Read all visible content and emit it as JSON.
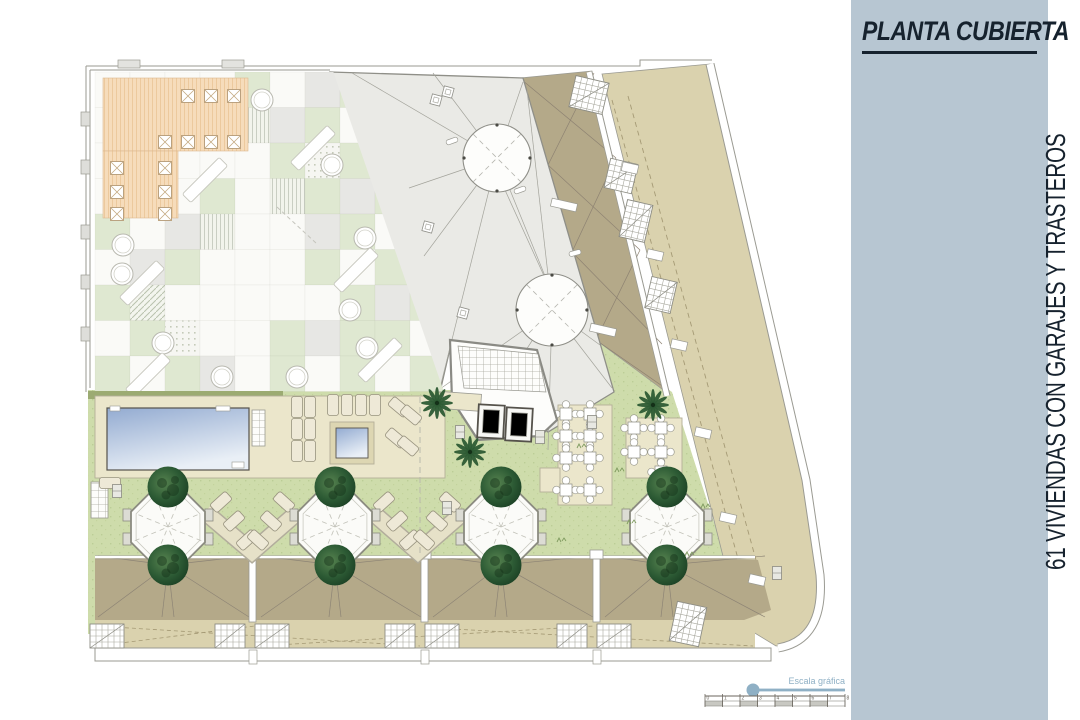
{
  "sidebar": {
    "title": "PLANTA CUBIERTA",
    "subtitle_vertical": "61 VIVIENDAS CON GARAJES Y TRASTEROS",
    "bg": "#b7c6d2",
    "text_color": "#16222e"
  },
  "scalebar": {
    "label": "Escala gráfica",
    "numbers": [
      "0",
      "1",
      "2",
      "3",
      "4",
      "5",
      "6",
      "7",
      "8"
    ],
    "color": "#8fb0c5",
    "ruler_color": "#6b665e"
  },
  "plan": {
    "colors": {
      "lawn": "#cedcab",
      "lawn_dot": "#bccd96",
      "hedge": "#9cab72",
      "deck": "#ebe6cb",
      "deck_stroke": "#b3ae98",
      "roof_gray": "#eaeae6",
      "roof_stroke": "#8f8f88",
      "roof_line": "#a3a39b",
      "khaki_dark": "#b4a989",
      "khaki_light": "#dad2ae",
      "orange": "#f6dcbb",
      "orange_line": "#ecc99d",
      "tile_green": "#dfe8d1",
      "tile_gray": "#e7e7e4",
      "tile_white": "#fafaf7",
      "pool_top": "#93abd1",
      "pool_bottom": "#e9eff6",
      "tree_dark": "#143018",
      "palm": "#2d5b34",
      "outline": "#9a9a92",
      "dash": "#a59a75",
      "fan_line": "#8d8475"
    },
    "terrace_tiles": {
      "rows": [
        "OOOOGWYGWG",
        "OOOOSYGWGW",
        "OOOOWGDGYG",
        "OOWGWSGYGW",
        "GWYSWWYGWG",
        "WYGWWWGWGY",
        "GHWWWWWGYG",
        "WGDWWGYGGW",
        "GWGYWGWGWG"
      ]
    },
    "terrace_tables": [
      [
        188,
        96
      ],
      [
        211,
        96
      ],
      [
        234,
        96
      ],
      [
        165,
        142
      ],
      [
        188,
        142
      ],
      [
        211,
        142
      ],
      [
        234,
        142
      ],
      [
        117,
        168
      ],
      [
        165,
        168
      ],
      [
        117,
        192
      ],
      [
        165,
        192
      ],
      [
        117,
        214
      ],
      [
        165,
        214
      ]
    ],
    "planters": [
      [
        262,
        100
      ],
      [
        332,
        165
      ],
      [
        365,
        238
      ],
      [
        123,
        245
      ],
      [
        122,
        274
      ],
      [
        163,
        343
      ],
      [
        222,
        377
      ],
      [
        297,
        377
      ],
      [
        367,
        348
      ],
      [
        350,
        310
      ]
    ],
    "benches": [
      [
        205,
        180
      ],
      [
        313,
        148
      ],
      [
        142,
        283
      ],
      [
        356,
        270
      ],
      [
        148,
        375
      ],
      [
        380,
        360
      ]
    ],
    "loungers": [
      [
        297,
        407,
        0
      ],
      [
        310,
        407,
        0
      ],
      [
        297,
        429,
        0
      ],
      [
        310,
        429,
        0
      ],
      [
        297,
        451,
        0
      ],
      [
        310,
        451,
        0
      ],
      [
        333,
        405,
        0
      ],
      [
        347,
        405,
        0
      ],
      [
        361,
        405,
        0
      ],
      [
        375,
        405,
        0
      ],
      [
        399,
        407,
        -50
      ],
      [
        411,
        415,
        -50
      ],
      [
        396,
        438,
        -50
      ],
      [
        408,
        446,
        -50
      ],
      [
        110,
        483,
        90
      ],
      [
        221,
        502,
        48
      ],
      [
        234,
        521,
        48
      ],
      [
        247,
        540,
        48
      ],
      [
        258,
        540,
        -48
      ],
      [
        271,
        521,
        -48
      ],
      [
        284,
        502,
        -48
      ],
      [
        384,
        502,
        48
      ],
      [
        397,
        521,
        48
      ],
      [
        410,
        540,
        48
      ],
      [
        424,
        540,
        -48
      ],
      [
        437,
        521,
        -48
      ],
      [
        450,
        502,
        -48
      ]
    ],
    "patio_tables": [
      [
        566,
        414
      ],
      [
        590,
        414
      ],
      [
        566,
        436
      ],
      [
        590,
        436
      ],
      [
        566,
        458
      ],
      [
        590,
        458
      ],
      [
        566,
        490
      ],
      [
        590,
        490
      ],
      [
        634,
        428
      ],
      [
        661,
        428
      ],
      [
        634,
        452
      ],
      [
        661,
        452
      ],
      [
        661,
        472
      ]
    ],
    "octagon_xs": [
      168,
      335,
      501,
      667
    ],
    "octagon_y": 527,
    "trees": [
      [
        168,
        487
      ],
      [
        335,
        487
      ],
      [
        501,
        487
      ],
      [
        667,
        487
      ],
      [
        168,
        565
      ],
      [
        335,
        565
      ],
      [
        501,
        565
      ],
      [
        667,
        565
      ]
    ],
    "palms": [
      [
        437,
        403
      ],
      [
        470,
        452
      ],
      [
        653,
        405
      ]
    ],
    "roof_units": [
      [
        95,
        252
      ],
      [
        258,
        424
      ],
      [
        430,
        596
      ],
      [
        602,
        768
      ]
    ],
    "unit_tree_xs": [
      168,
      335,
      501,
      667
    ],
    "hatch_boxes": [
      [
        589,
        95,
        13,
        34,
        32
      ],
      [
        621,
        176,
        13,
        28,
        30
      ],
      [
        636,
        221,
        13,
        26,
        38
      ],
      [
        661,
        295,
        13,
        26,
        32
      ],
      [
        107,
        636,
        0,
        34,
        24
      ],
      [
        230,
        636,
        0,
        30,
        24
      ],
      [
        272,
        636,
        0,
        34,
        24
      ],
      [
        400,
        636,
        0,
        30,
        24
      ],
      [
        442,
        636,
        0,
        34,
        24
      ],
      [
        572,
        636,
        0,
        30,
        24
      ],
      [
        614,
        636,
        0,
        34,
        24
      ],
      [
        688,
        624,
        12,
        30,
        40
      ]
    ],
    "notches": [
      [
        630,
        168
      ],
      [
        655,
        255
      ],
      [
        679,
        345
      ],
      [
        703,
        433
      ],
      [
        728,
        518
      ],
      [
        757,
        580
      ]
    ],
    "band_walls": [
      [
        564,
        205
      ],
      [
        603,
        330
      ]
    ],
    "pills": [
      [
        452,
        141,
        -20
      ],
      [
        520,
        190,
        -20
      ],
      [
        575,
        253,
        -15
      ]
    ],
    "badges": [
      [
        436,
        100
      ],
      [
        448,
        92
      ],
      [
        428,
        227
      ],
      [
        463,
        313
      ]
    ],
    "vents": [
      [
        460,
        432
      ],
      [
        540,
        437
      ],
      [
        592,
        422
      ],
      [
        447,
        508
      ],
      [
        777,
        573
      ],
      [
        117,
        491
      ]
    ],
    "edge_marks": [
      [
        81,
        112
      ],
      [
        81,
        160
      ],
      [
        81,
        225
      ],
      [
        81,
        275
      ],
      [
        81,
        327
      ]
    ],
    "top_marks": [
      [
        118,
        60
      ],
      [
        222,
        60
      ]
    ],
    "tufts": [
      [
        580,
        448
      ],
      [
        630,
        524
      ],
      [
        704,
        508
      ],
      [
        560,
        542
      ],
      [
        618,
        472
      ],
      [
        688,
        556
      ]
    ],
    "skylights": [
      [
        497,
        158,
        34
      ],
      [
        552,
        310,
        36
      ]
    ],
    "roof_lines": [
      [
        497,
        158,
        352,
        73
      ],
      [
        497,
        158,
        433,
        73
      ],
      [
        497,
        158,
        523,
        82
      ],
      [
        497,
        158,
        409,
        188
      ],
      [
        497,
        158,
        424,
        256
      ],
      [
        497,
        158,
        440,
        388
      ],
      [
        497,
        158,
        545,
        276
      ],
      [
        505,
        190,
        545,
        278
      ],
      [
        552,
        310,
        527,
        90
      ],
      [
        552,
        310,
        440,
        389
      ],
      [
        552,
        310,
        478,
        424
      ],
      [
        552,
        310,
        548,
        450
      ],
      [
        552,
        310,
        612,
        388
      ],
      [
        552,
        310,
        600,
        345
      ]
    ],
    "dark_band_lines": [
      [
        522,
        80,
        616,
        158
      ],
      [
        548,
        165,
        594,
        73
      ],
      [
        548,
        165,
        640,
        250
      ],
      [
        572,
        252,
        616,
        158
      ],
      [
        572,
        252,
        662,
        344
      ],
      [
        596,
        340,
        640,
        250
      ],
      [
        596,
        340,
        668,
        390
      ]
    ]
  }
}
